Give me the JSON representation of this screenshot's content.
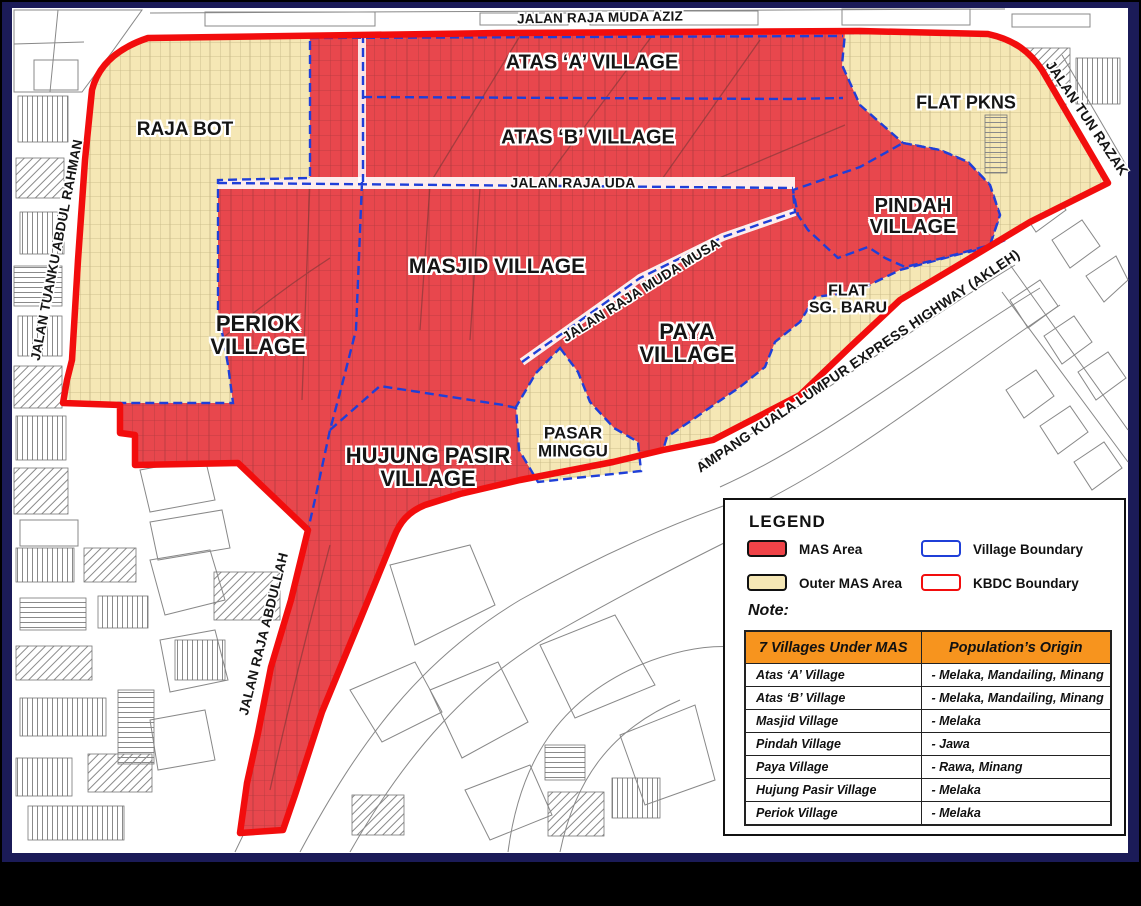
{
  "map": {
    "roads": {
      "jalan_raja_muda_aziz": "JALAN RAJA MUDA AZIZ",
      "jalan_tuanku_abdul_rahman": "JALAN TUANKU ABDUL RAHMAN",
      "jalan_tun_razak": "JALAN TUN RAZAK",
      "jalan_raja_uda": "JALAN RAJA UDA",
      "jalan_raja_muda_musa": "JALAN RAJA MUDA MUSA",
      "jalan_raja_abdullah": "JALAN RAJA ABDULLAH",
      "akleh_highway": "AMPANG KUALA LUMPUR EXPRESS HIGHWAY (AKLEH)"
    },
    "areas": {
      "atas_a": "ATAS ‘A’ VILLAGE",
      "atas_b": "ATAS ‘B’ VILLAGE",
      "masjid": "MASJID VILLAGE",
      "periok": "PERIOK\nVILLAGE",
      "paya": "PAYA\nVILLAGE",
      "pindah": "PINDAH\nVILLAGE",
      "hujung_pasir": "HUJUNG PASIR\nVILLAGE",
      "raja_bot": "RAJA BOT",
      "flat_pkns": "FLAT PKNS",
      "flat_sg_baru": "FLAT\nSG. BARU",
      "pasar_minggu": "PASAR\nMINGGU"
    }
  },
  "legend": {
    "title": "LEGEND",
    "items": [
      {
        "label": "MAS Area"
      },
      {
        "label": "Outer MAS Area"
      },
      {
        "label": "Village Boundary"
      },
      {
        "label": "KBDC Boundary"
      }
    ],
    "note_label": "Note:",
    "table": {
      "headers": [
        "7 Villages Under MAS",
        "Population’s Origin"
      ],
      "rows": [
        {
          "village": "Atas ‘A’ Village",
          "origin": "- Melaka, Mandailing, Minang"
        },
        {
          "village": "Atas ‘B’ Village",
          "origin": "- Melaka, Mandailing, Minang"
        },
        {
          "village": "Masjid Village",
          "origin": "- Melaka"
        },
        {
          "village": "Pindah Village",
          "origin": "- Jawa"
        },
        {
          "village": "Paya Village",
          "origin": "- Rawa, Minang"
        },
        {
          "village": "Hujung Pasir Village",
          "origin": "- Melaka"
        },
        {
          "village": "Periok Village",
          "origin": "- Melaka"
        }
      ]
    }
  },
  "colors": {
    "mas_area": "#EF4348",
    "outer_mas_area": "#F5E7B5",
    "village_boundary": "#1F3FD8",
    "kbdc_boundary": "#F20D0D",
    "table_header": "#F7941E",
    "frame": "#1B1B58"
  }
}
